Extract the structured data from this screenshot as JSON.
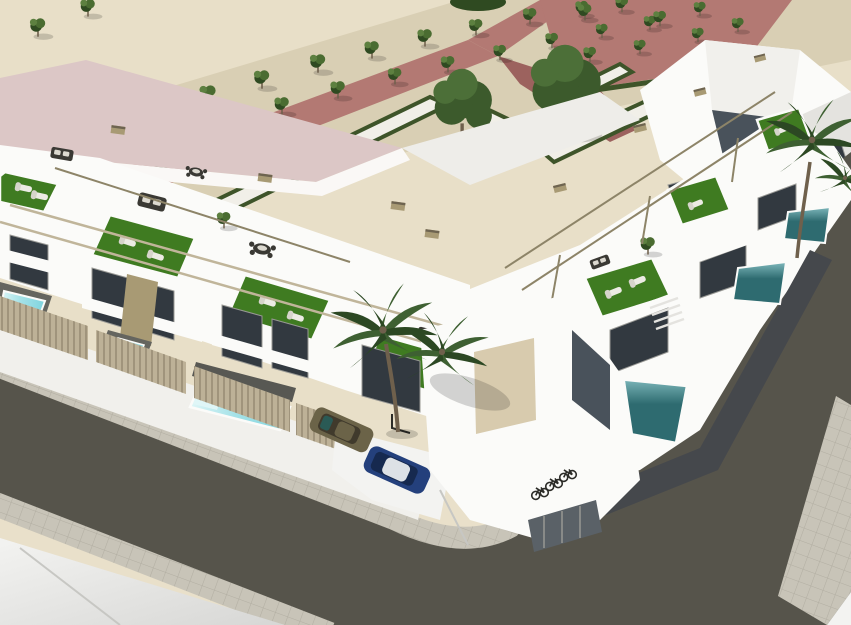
{
  "meta": {
    "kind": "3D architectural exterior rendering (aerial view)",
    "description": "New-build development of white modern townhouses on a street corner, with rooftop terraces (artificial grass, sun loungers, sofa sets, pergola frames), private plunge pools, a landscaped park with formal hedges and orchard trees behind, asphalt streets with paver sidewalks wrapping a rounded corner, two parked cars, bicycles and palm trees.",
    "image_width": 851,
    "image_height": 625
  },
  "scene": {
    "park": {
      "ground": "beige sand gravel",
      "features": [
        "pink walkways",
        "pink plaza",
        "white paths bordered by clipped hedges",
        "grid of small orchard trees",
        "two large leafy trees"
      ],
      "orchard_tree_count": 27
    },
    "buildings": {
      "left_row_townhouse_units": 4,
      "right_row_townhouse_units": 3,
      "corner_unit": "white unit with beige garage door and bicycle parking alcove",
      "background_left": "large building with pale pink flat roof",
      "background_right": "tall white faceted building"
    },
    "amenities": {
      "rooftop_terraces": "artificial grass, white sun loungers, charcoal sofa sets, dining sets, slim pergola frames",
      "front_plunge_pools_turquoise": 3,
      "rear_pools_teal": 3,
      "palm_trees": 3,
      "bicycles": 3
    },
    "vehicles": {
      "car_1": "olive-bronze compact parked behind slatted fence",
      "car_2": "dark blue compact with white roof on driveway",
      "car_3": "dark car on right street (distant)"
    },
    "streets": {
      "left_street": "dark asphalt running lower-left, descending to the right",
      "right_street": "dark asphalt rising to the upper right",
      "corner": "rounded paver sidewalk corner at bottom centre",
      "sidewalks": "light paver bands on both sides"
    }
  },
  "palette": {
    "sand": "#e8dfc8",
    "sandshadow": "#d9cfb4",
    "pink": "#b37973",
    "pinkdark": "#9c625e",
    "whitepath": "#f1efe8",
    "hedge": "#3e5429",
    "tree": "#4a6c31",
    "tree2": "#5d8040",
    "treedark": "#2f4a21",
    "trunk": "#6f604c",
    "bigtree": "#3c5a2c",
    "bigtree2": "#4c6f38",
    "palm": "#3e6032",
    "palmdark": "#2c4823",
    "roofpink": "#dcc7c6",
    "roofparapet": "#faf8f6",
    "white": "#fbfbf9",
    "white2": "#f1f0ec",
    "white3": "#e4e3df",
    "grayface": "#c9c8c4",
    "slope": "#eeede9",
    "glass": "#323940",
    "glassblue": "#49525b",
    "frame": "#989894",
    "grass": "#3f7b21",
    "grass2": "#559a2d",
    "lounger": "#ecebe4",
    "loungerback": "#d6d4cb",
    "sofa": "#3a3934",
    "cushion": "#dcd9d0",
    "rail": "#c0b59a",
    "raildark": "#8d8468",
    "cap": "#a89a74",
    "capdark": "#6e6450",
    "fence": "#bdb197",
    "slatline": "#93886f",
    "deck": "#65655f",
    "deck2": "#585853",
    "poolsteps": "#dff6f7",
    "pool1": "#a5e2e8",
    "pool2": "#7fd4de",
    "tealL": "#7fb9bd",
    "teal": "#2e6b70",
    "road": "#56544b",
    "sidewalk": "#c8c4b8",
    "paverline": "#b2aea2",
    "curb": "#8d8a80",
    "groundA": "#f3f3f1",
    "groundB": "#d7d7d5",
    "seam": "#c7c7c3",
    "garage": "#d8cbae",
    "darkpanel": "#5a6167",
    "bike": "#2c2c28",
    "carolive": "#6b6348",
    "carolivedk": "#403a2c",
    "carglass": "#2a5a55",
    "carblue": "#24407c",
    "carbluedk": "#16294f",
    "carroof": "#dde1e6",
    "darkband": "#45484c",
    "darkcar": "#1f2326",
    "shadow": "rgba(0,0,0,0.16)"
  }
}
